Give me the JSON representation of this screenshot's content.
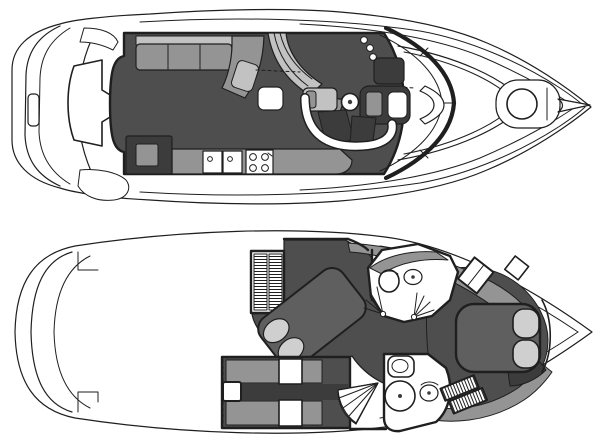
{
  "palette": {
    "line": "#1f1f1f",
    "paper": "#ffffff",
    "floor": "#4e4e4e",
    "furniture": "#949494",
    "cushion": "#c2c2c2",
    "pillow": "#cfcfcf",
    "bed": "#5f5f5f",
    "shadow": "#3c3c3c"
  },
  "figure": {
    "type": "yacht-two-deck-floorplan",
    "views": [
      {
        "id": "upper-deck",
        "features": [
          "swim platform",
          "engine hatch",
          "cockpit steps",
          "L-settee with cushions",
          "companionway steps",
          "helm console with steering wheel",
          "helm seat",
          "galley counter with double sink and 4-burner stove",
          "refrigerator",
          "curved windshield",
          "foredeck walkthrough vent",
          "bow hatch circle",
          "anchor locker",
          "bow pulpit"
        ]
      },
      {
        "id": "lower-deck",
        "features": [
          "swim platform",
          "companionway ladder (hatched)",
          "mid-cabin diagonal berth with two pillows",
          "mid-cabin lounge with table",
          "fan stairs",
          "aft head with shower basin and toilet",
          "hatched steps",
          "forward head with toilet, basin and door swings",
          "hanging locker",
          "forward stateroom island berth with two pillows",
          "hull-side cabinetry"
        ]
      }
    ]
  }
}
